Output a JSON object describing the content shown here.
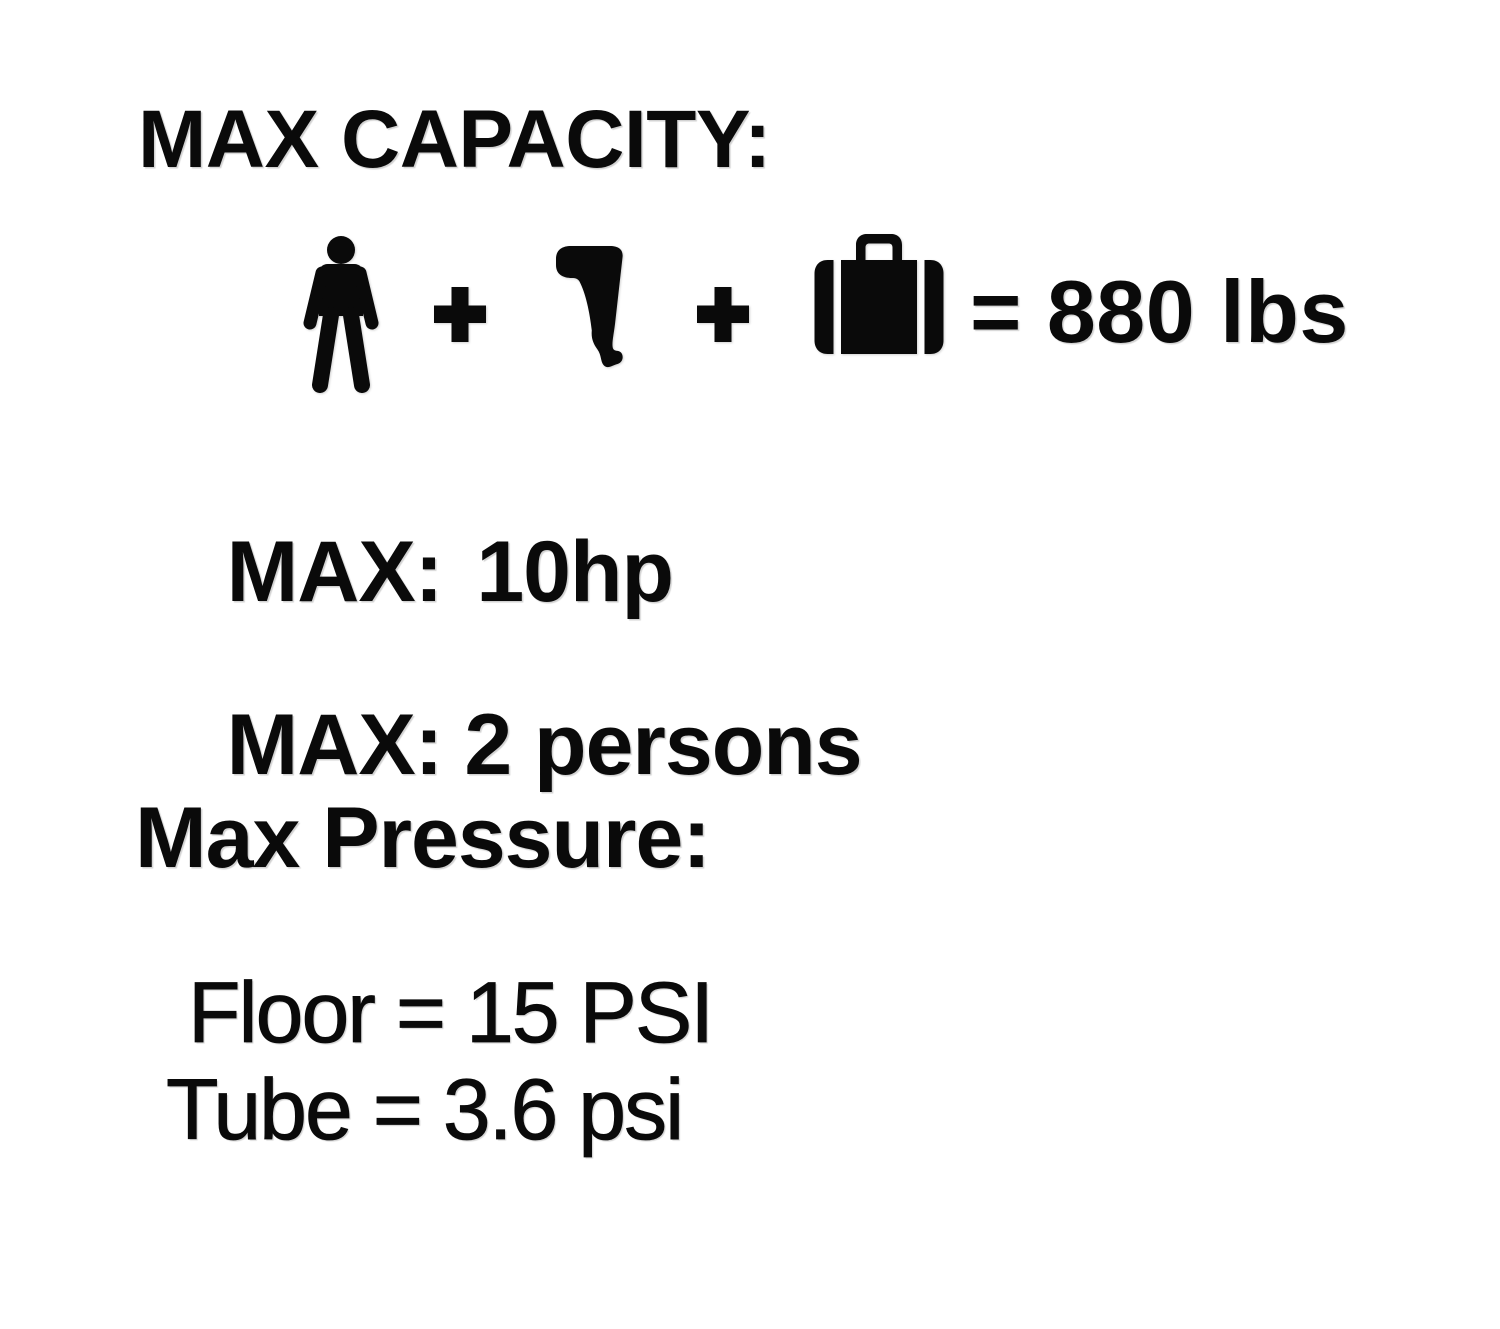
{
  "colors": {
    "background": "#ffffff",
    "ink": "#0a0a0a"
  },
  "capacity": {
    "heading": "MAX CAPACITY:",
    "equation": {
      "operand_icons": [
        "person-icon",
        "outboard-motor-icon",
        "luggage-icon"
      ],
      "operator": "+",
      "result": "= 880 lbs"
    }
  },
  "specs": [
    {
      "label": "MAX:",
      "value": "10hp"
    },
    {
      "label": "MAX:",
      "value": "2 persons"
    }
  ],
  "pressure": {
    "heading": "Max Pressure:",
    "lines": [
      {
        "text": "Floor = 15 PSI"
      },
      {
        "text": "Tube = 3.6 psi"
      }
    ]
  }
}
